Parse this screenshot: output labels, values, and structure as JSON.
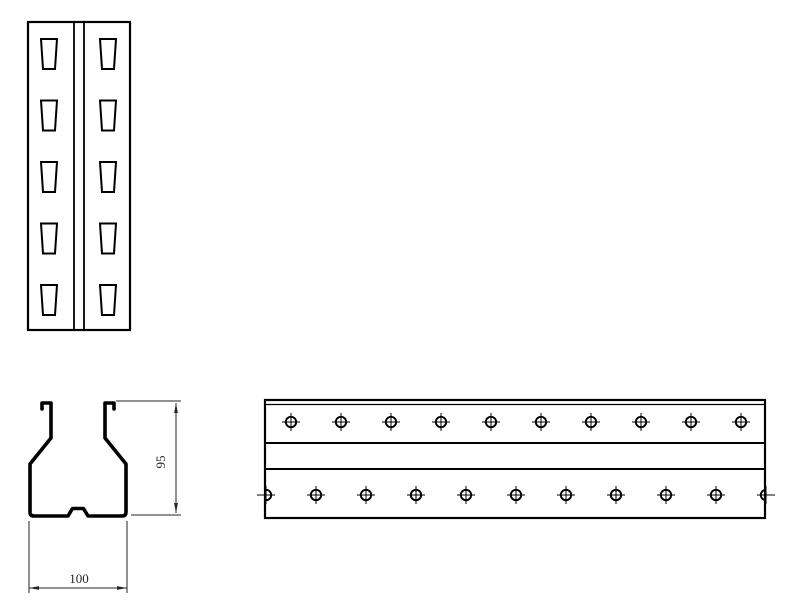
{
  "drawing": {
    "name": "storage-rack-upright-technical-drawing",
    "colors": {
      "background": "#ffffff",
      "line": "#000000",
      "dimension": "#26262e"
    },
    "front_view": {
      "frame": {
        "x": 28,
        "y": 22,
        "width": 102,
        "height": 308
      },
      "fold_lines_x": [
        74,
        84
      ],
      "slot_columns_cx": [
        49,
        108
      ],
      "slot_rows_top_y": [
        39,
        100.5,
        162,
        223.5,
        285
      ],
      "slot": {
        "top_width": 16,
        "bottom_width": 12,
        "height": 30
      }
    },
    "section_view": {
      "width_dim": {
        "label": "100",
        "line_y": 588,
        "x1": 29,
        "x2": 127,
        "ext_top_y": 521,
        "text_x": 79,
        "text_y": 583
      },
      "height_dim": {
        "label": "95",
        "line_x": 176,
        "y1": 403,
        "y2": 513,
        "ext_top": {
          "x1": 116,
          "x2": 181,
          "y": 401
        },
        "ext_bottom": {
          "x1": 131,
          "x2": 181,
          "y": 515
        },
        "text_x": 165,
        "text_y": 462
      }
    },
    "beam_view": {
      "frame": {
        "x": 265,
        "y": 400,
        "width": 500,
        "height": 118
      },
      "flange_line_offset_y": 4.5,
      "web_lines_offset_y": [
        43,
        69
      ],
      "hole": {
        "radius": 5.2,
        "cross_arm": 9
      },
      "hole_rows": [
        {
          "cy_offset": 22,
          "first_cx_offset": 26,
          "spacing": 50,
          "count": 10
        },
        {
          "cy_offset": 95,
          "first_cx_offset": 1,
          "spacing": 50,
          "count": 11
        }
      ]
    }
  }
}
